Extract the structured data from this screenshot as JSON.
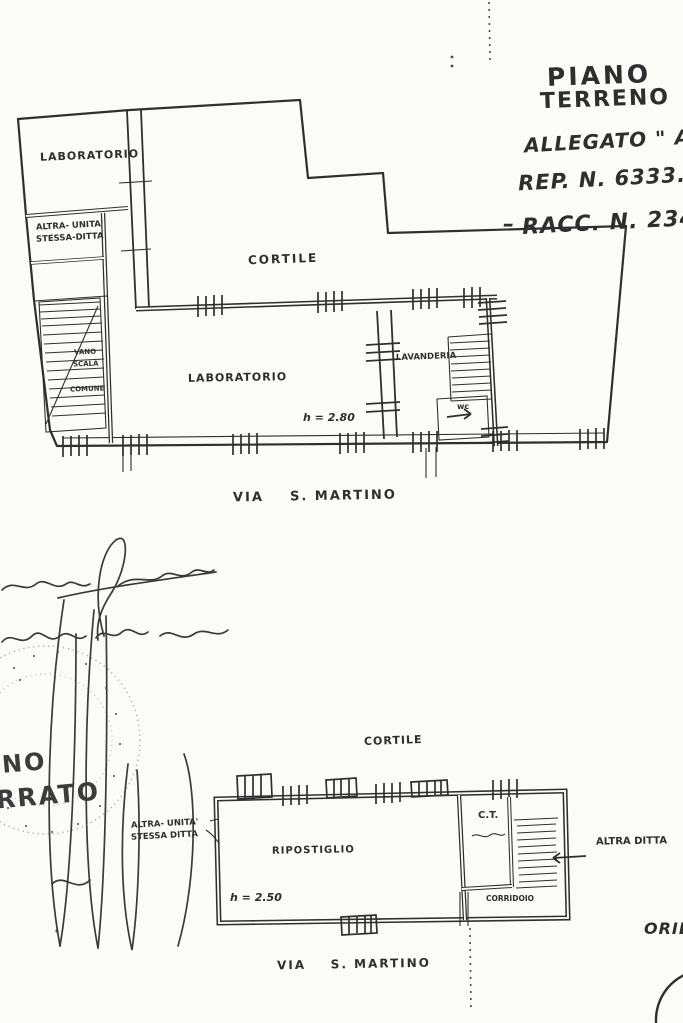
{
  "page": {
    "background": "#fbfbf8",
    "ink_color": "#2f2f2f"
  },
  "header": {
    "title_line1": "PIANO",
    "title_line2": "TERRENO",
    "allegato": "ALLEGATO \" A",
    "rep": "REP. N. 6333.",
    "dash": "–",
    "racc": "RACC. N. 2347"
  },
  "upper_plan": {
    "rooms": {
      "laboratorio_top": "LABORATORIO",
      "altra_unita_line1": "ALTRA- UNITA'",
      "altra_unita_line2": "STESSA-DITTA",
      "cortile": "CORTILE",
      "vano_scala_line1": "VANO",
      "vano_scala_line2": "SCALA",
      "vano_scala_line3": "COMUNE",
      "laboratorio_main": "LABORATORIO",
      "lavanderia": "LAVANDERIA",
      "wc": "wc",
      "height_note": "h = 2.80"
    },
    "street_label": "VIA    S. MARTINO"
  },
  "handwriting": {
    "signature_line1": "(firma corsiva illeggibile)",
    "signature_line2": "(scritta corsiva illeggibile)",
    "stamp_text_line1": "NO",
    "stamp_text_line2": "RRATO"
  },
  "lower_plan": {
    "labels": {
      "cortile": "CORTILE",
      "altra_unita_line1": "ALTRA- UNITA'",
      "altra_unita_line2": "STESSA DITTA",
      "ripostiglio": "RIPOSTIGLIO",
      "height_note": "h = 2.50",
      "ct": "C.T.",
      "ct_note": "(scritta illeggibile)",
      "corridoio": "CORRIDOIO",
      "altra_ditta": "ALTRA DITTA"
    },
    "street_label": "VIA    S. MARTINO"
  },
  "footer": {
    "orientation_label": "ORIEN"
  }
}
